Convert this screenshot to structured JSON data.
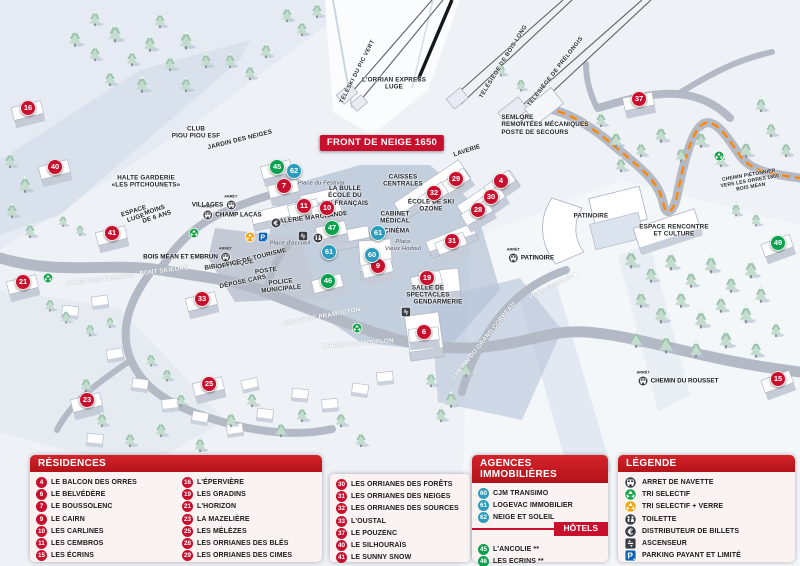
{
  "map": {
    "banner": "FRONT DE NEIGE 1650",
    "markers": [
      {
        "n": "16",
        "x": 28,
        "y": 108,
        "t": "res"
      },
      {
        "n": "40",
        "x": 55,
        "y": 167,
        "t": "res"
      },
      {
        "n": "21",
        "x": 23,
        "y": 282,
        "t": "res"
      },
      {
        "n": "41",
        "x": 112,
        "y": 233,
        "t": "res"
      },
      {
        "n": "33",
        "x": 202,
        "y": 299,
        "t": "res"
      },
      {
        "n": "23",
        "x": 87,
        "y": 400,
        "t": "res"
      },
      {
        "n": "25",
        "x": 209,
        "y": 384,
        "t": "res"
      },
      {
        "n": "7",
        "x": 284,
        "y": 186,
        "t": "res"
      },
      {
        "n": "11",
        "x": 304,
        "y": 206,
        "t": "res"
      },
      {
        "n": "10",
        "x": 327,
        "y": 208,
        "t": "res"
      },
      {
        "n": "9",
        "x": 378,
        "y": 266,
        "t": "res"
      },
      {
        "n": "19",
        "x": 427,
        "y": 278,
        "t": "res"
      },
      {
        "n": "6",
        "x": 424,
        "y": 332,
        "t": "res",
        "r": -5
      },
      {
        "n": "29",
        "x": 456,
        "y": 179,
        "t": "res",
        "r": -35
      },
      {
        "n": "32",
        "x": 434,
        "y": 193,
        "t": "res",
        "r": -35
      },
      {
        "n": "4",
        "x": 501,
        "y": 181,
        "t": "res",
        "r": -35
      },
      {
        "n": "30",
        "x": 491,
        "y": 197,
        "t": "res",
        "r": -35
      },
      {
        "n": "28",
        "x": 478,
        "y": 210,
        "t": "res",
        "r": -30
      },
      {
        "n": "31",
        "x": 452,
        "y": 241,
        "t": "res",
        "r": -22
      },
      {
        "n": "37",
        "x": 639,
        "y": 99,
        "t": "res",
        "r": -12
      },
      {
        "n": "15",
        "x": 778,
        "y": 379,
        "t": "res",
        "r": -20
      },
      {
        "n": "60",
        "x": 372,
        "y": 255,
        "t": "ag"
      },
      {
        "n": "61",
        "x": 378,
        "y": 233,
        "t": "ag"
      },
      {
        "n": "61",
        "x": 329,
        "y": 252,
        "t": "ag"
      },
      {
        "n": "62",
        "x": 294,
        "y": 171,
        "t": "ag"
      },
      {
        "n": "45",
        "x": 277,
        "y": 167,
        "t": "hot"
      },
      {
        "n": "47",
        "x": 332,
        "y": 228,
        "t": "hot"
      },
      {
        "n": "46",
        "x": 328,
        "y": 281,
        "t": "hot"
      },
      {
        "n": "49",
        "x": 778,
        "y": 243,
        "t": "hot",
        "r": -20
      }
    ],
    "labels": [
      {
        "text": "TÉLÉSKI DU PIC VERT",
        "x": 358,
        "y": 72,
        "r": -63,
        "c": "lift"
      },
      {
        "text": "L'ORRIAN EXPRESS\nLUGE",
        "x": 394,
        "y": 84,
        "c": "pl"
      },
      {
        "text": "TÉLÉSIÈGE DE BOIS LONG",
        "x": 504,
        "y": 62,
        "r": -58,
        "c": "lift"
      },
      {
        "text": "TÉLÉSIÈGE DE PRÉLONGIS",
        "x": 556,
        "y": 72,
        "r": -52,
        "c": "lift"
      },
      {
        "text": "SEMLORE\nREMONTÉES MÉCANIQUES\nPOSTE DE SECOURS",
        "x": 545,
        "y": 125,
        "c": "pl left"
      },
      {
        "text": "LAVERIE",
        "x": 467,
        "y": 151,
        "r": -18,
        "c": "pl"
      },
      {
        "text": "CAISSES\nCENTRALES",
        "x": 403,
        "y": 181,
        "c": "pl"
      },
      {
        "text": "ÉCOLE DE SKI\nOZONE",
        "x": 431,
        "y": 206,
        "c": "pl"
      },
      {
        "text": "CABINET\nMÉDICAL",
        "x": 395,
        "y": 218,
        "c": "pl"
      },
      {
        "text": "CINÉMA",
        "x": 397,
        "y": 231,
        "c": "pl"
      },
      {
        "text": "Place\nVieux Hodoul",
        "x": 403,
        "y": 246,
        "c": "it"
      },
      {
        "text": "LA BULLE\nÉCOLE DU\nSKI FRANÇAIS",
        "x": 345,
        "y": 196,
        "c": "pl"
      },
      {
        "text": "GALERIE MARCHANDE",
        "x": 311,
        "y": 218,
        "r": -7,
        "c": "pl"
      },
      {
        "text": "Place du Festival",
        "x": 321,
        "y": 184,
        "c": "it"
      },
      {
        "text": "CLUB\nPIOU PIOU ESF",
        "x": 196,
        "y": 133,
        "c": "pl"
      },
      {
        "text": "JARDIN DES NEIGES",
        "x": 240,
        "y": 140,
        "r": -14,
        "c": "pl"
      },
      {
        "text": "HALTE GARDERIE\n«LES PITCHOUNETS»",
        "x": 146,
        "y": 182,
        "c": "pl"
      },
      {
        "text": "ESPACE\nLUGE",
        "x": 135,
        "y": 215,
        "r": -18,
        "c": "pl"
      },
      {
        "text": "MOINS\nDE 6 ANS",
        "x": 156,
        "y": 214,
        "r": -18,
        "c": "pl"
      },
      {
        "text": "PONT SKIEURS",
        "x": 164,
        "y": 271,
        "r": -7,
        "c": "rd"
      },
      {
        "text": "ALLÉE DES CHAMOIS",
        "x": 100,
        "y": 280,
        "r": -7,
        "c": "rd"
      },
      {
        "text": "BIBLIOTHÈQUE",
        "x": 229,
        "y": 265,
        "r": -8,
        "c": "pl"
      },
      {
        "text": "OFFICE DE TOURISME",
        "x": 252,
        "y": 259,
        "r": -14,
        "c": "pl"
      },
      {
        "text": "POSTE",
        "x": 266,
        "y": 271,
        "r": -8,
        "c": "pl"
      },
      {
        "text": "POLICE\nMUNICIPALE",
        "x": 281,
        "y": 286,
        "r": -6,
        "c": "pl"
      },
      {
        "text": "DÉPOSE CARS",
        "x": 243,
        "y": 282,
        "r": -12,
        "c": "pl"
      },
      {
        "text": "Place d'accueil",
        "x": 290,
        "y": 244,
        "c": "it"
      },
      {
        "text": "ROUTE DE PRAMOUTON",
        "x": 322,
        "y": 317,
        "r": -11,
        "c": "rd"
      },
      {
        "text": "CHEMIN DU MOUFLON",
        "x": 358,
        "y": 344,
        "r": -5,
        "c": "rd"
      },
      {
        "text": "CHEMIN DU GRAND CORBEAU",
        "x": 484,
        "y": 341,
        "r": -51,
        "c": "rd"
      },
      {
        "text": "VERS EMBRUN ▶",
        "x": 554,
        "y": 286,
        "r": -27,
        "c": "rd"
      },
      {
        "text": "SALLE DE\nSPECTACLES",
        "x": 428,
        "y": 292,
        "c": "pl"
      },
      {
        "text": "GENDARMERIE",
        "x": 438,
        "y": 302,
        "c": "pl"
      },
      {
        "text": "PATINOIRE",
        "x": 591,
        "y": 216,
        "c": "pl"
      },
      {
        "text": "ESPACE RENCONTRE\nET CULTURE",
        "x": 674,
        "y": 231,
        "c": "pl"
      },
      {
        "text": "CHEMIN PIÉTONNIER\nVERS LES ORRES 1800\nBOIS MÉAN",
        "x": 750,
        "y": 182,
        "r": -10,
        "c": "pl tiny"
      }
    ],
    "bus_stops": [
      {
        "tag": "ARRÊT",
        "label": "VILLAGES",
        "x": 214,
        "y": 205,
        "side": "left"
      },
      {
        "tag": "ARRÊT",
        "label": "CHAMP LACAS",
        "x": 232,
        "y": 215,
        "side": "right"
      },
      {
        "tag": "ARRÊT",
        "label": "BOIS MÉAN ET EMBRUN",
        "x": 187,
        "y": 257,
        "side": "left"
      },
      {
        "tag": "ARRÊT",
        "label": "PATINOIRE",
        "x": 531,
        "y": 258,
        "side": "right"
      },
      {
        "tag": "ARRÊT",
        "label": "CHEMIN DU ROUSSET",
        "x": 678,
        "y": 381,
        "side": "right"
      }
    ],
    "icons": [
      {
        "t": "parking",
        "x": 263,
        "y": 237
      },
      {
        "t": "tri-verre",
        "x": 250,
        "y": 237
      },
      {
        "t": "atm",
        "x": 276,
        "y": 223
      },
      {
        "t": "lift",
        "x": 303,
        "y": 236
      },
      {
        "t": "wc",
        "x": 318,
        "y": 238
      },
      {
        "t": "lift",
        "x": 406,
        "y": 312
      },
      {
        "t": "tri",
        "x": 48,
        "y": 278
      },
      {
        "t": "tri",
        "x": 194,
        "y": 233
      },
      {
        "t": "tri",
        "x": 357,
        "y": 328
      },
      {
        "t": "tri",
        "x": 719,
        "y": 156
      }
    ]
  },
  "panel": {
    "residences": {
      "title": "RÉSIDENCES",
      "col1": [
        {
          "n": "4",
          "label": "LE BALCON DES ORRES"
        },
        {
          "n": "6",
          "label": "LE BELVÉDÈRE"
        },
        {
          "n": "7",
          "label": "LE BOUSSOLENC"
        },
        {
          "n": "9",
          "label": "LE CAIRN"
        },
        {
          "n": "10",
          "label": "LES CARLINES"
        },
        {
          "n": "11",
          "label": "LES CEMBROS"
        },
        {
          "n": "15",
          "label": "LES ÉCRINS"
        }
      ],
      "col2": [
        {
          "n": "16",
          "label": "L'ÉPERVIÈRE"
        },
        {
          "n": "19",
          "label": "LES GRADINS"
        },
        {
          "n": "21",
          "label": "L'HORIZON"
        },
        {
          "n": "23",
          "label": "LA MAZELIÈRE"
        },
        {
          "n": "25",
          "label": "LES MÉLÈZES"
        },
        {
          "n": "28",
          "label": "LES ORRIANES DES BLÉS"
        },
        {
          "n": "29",
          "label": "LES ORRIANES DES CIMES"
        }
      ],
      "col3": [
        {
          "n": "30",
          "label": "LES ORRIANES DES FORÊTS"
        },
        {
          "n": "31",
          "label": "LES ORRIANES DES NEIGES"
        },
        {
          "n": "32",
          "label": "LES ORRIANES DES SOURCES"
        },
        {
          "n": "33",
          "label": "L'OUSTAL"
        },
        {
          "n": "37",
          "label": "LE POUZENC"
        },
        {
          "n": "40",
          "label": "LE SILHOURAÏS"
        },
        {
          "n": "41",
          "label": "LE SUNNY SNOW"
        }
      ]
    },
    "agences": {
      "title": "AGENCES IMMOBILIÈRES",
      "items": [
        {
          "n": "60",
          "label": "CJM TRANSIMO"
        },
        {
          "n": "61",
          "label": "LOGEVAC IMMOBILIER"
        },
        {
          "n": "62",
          "label": "NEIGE ET SOLEIL"
        }
      ]
    },
    "hotels": {
      "title": "HÔTELS",
      "items": [
        {
          "n": "45",
          "label": "L'ANCOLIE **"
        },
        {
          "n": "46",
          "label": "LES ECRINS **"
        },
        {
          "n": "47",
          "label": "L'ESCALE BLANCHE ***"
        },
        {
          "n": "49",
          "label": "LES TRAPPEURS **"
        }
      ]
    },
    "legende": {
      "title": "LÉGENDE",
      "items": [
        {
          "icon": "bus",
          "label": "ARRET DE NAVETTE"
        },
        {
          "icon": "tri",
          "label": "TRI SELECTIF"
        },
        {
          "icon": "tri-verre",
          "label": "TRI SELECTIF + VERRE"
        },
        {
          "icon": "wc",
          "label": "TOILETTE"
        },
        {
          "icon": "atm",
          "label": "DISTRIBUTEUR DE BILLETS"
        },
        {
          "icon": "lift",
          "label": "ASCENSEUR"
        },
        {
          "icon": "parking",
          "label": "PARKING PAYANT ET LIMITÉ"
        }
      ]
    }
  },
  "colors": {
    "residence_red": "#c8102e",
    "agence_blue": "#2b9cbd",
    "hotel_green": "#0aa14f",
    "parking_blue": "#0e62b4",
    "tri_green": "#16a24a",
    "tri_yellow": "#f3a40c",
    "path_orange": "#ff8400"
  }
}
